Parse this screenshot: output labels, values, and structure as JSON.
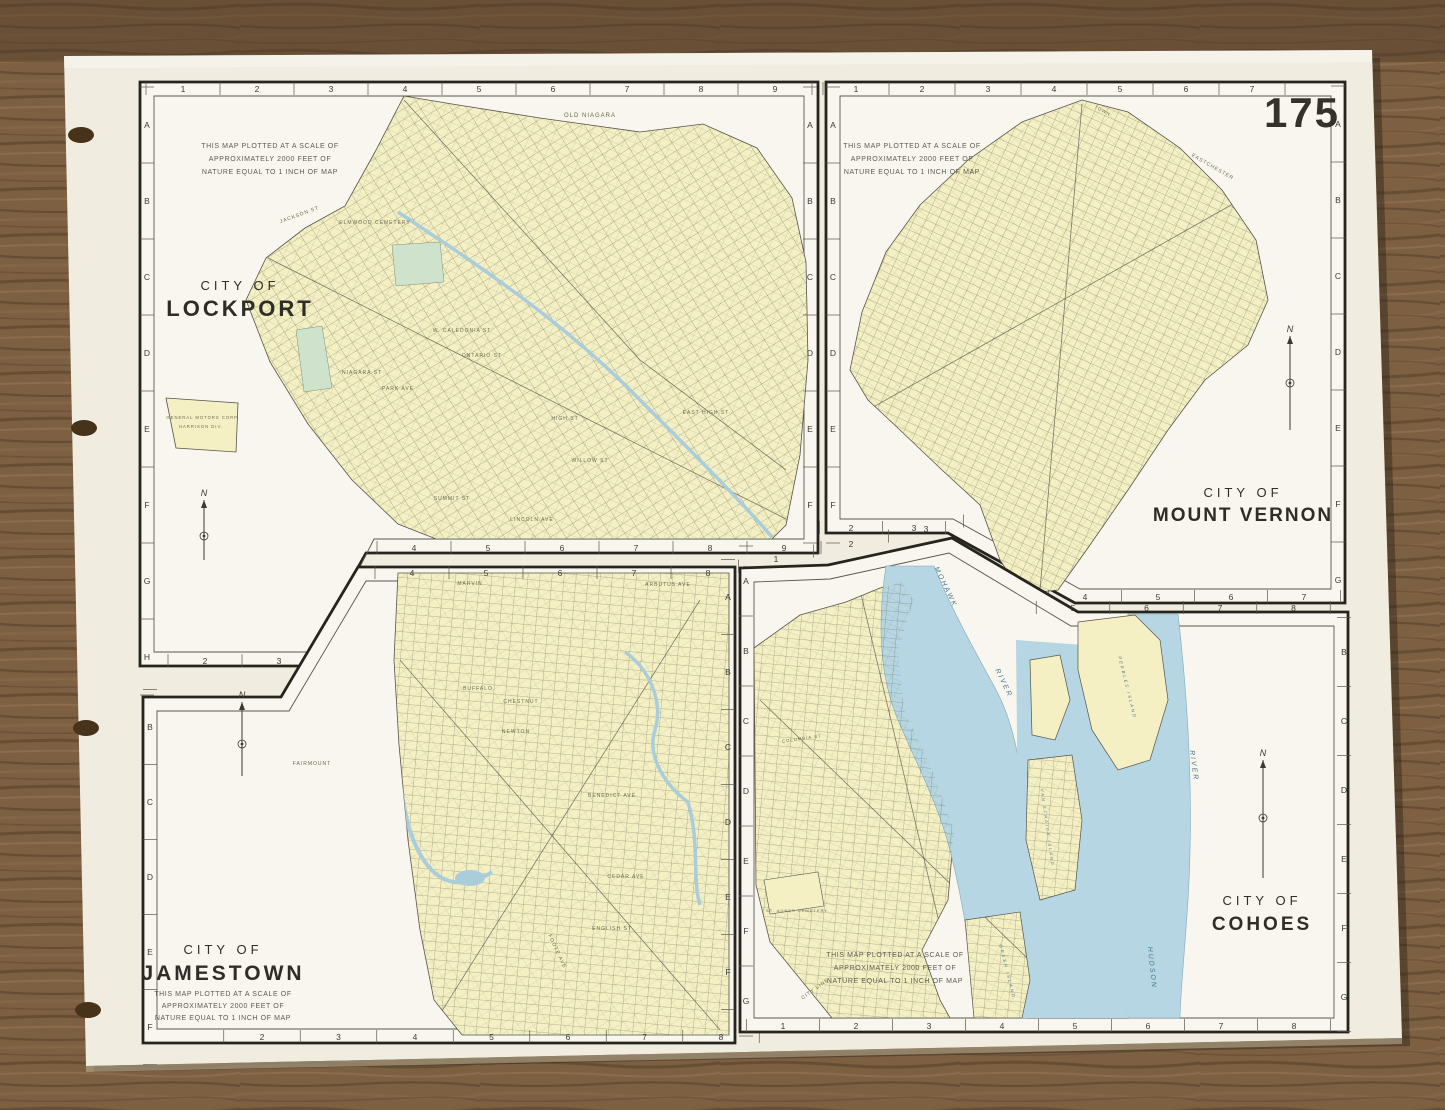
{
  "page_number": "175",
  "colors": {
    "wood": "#7d5f42",
    "wood_dark": "#4f3b27",
    "wood_light": "#98795a",
    "paper": "#f0ecdf",
    "panel_bg": "#f8f6ee",
    "map_fill": "#f4f0c4",
    "water": "#b5d6e2",
    "park": "#cfe2cb",
    "ink": "#26241f"
  },
  "panels": {
    "lockport": {
      "title_top": "CITY OF",
      "title_city": "LOCKPORT",
      "scale_note": [
        "THIS MAP PLOTTED AT A SCALE OF",
        "APPROXIMATELY  2000 FEET OF",
        "NATURE EQUAL TO 1 INCH OF MAP"
      ],
      "compass": "N",
      "rulers": {
        "top": [
          "1",
          "2",
          "3",
          "4",
          "5",
          "6",
          "7",
          "8",
          "9"
        ],
        "bottom": [
          "4",
          "5",
          "6",
          "7",
          "8",
          "9"
        ],
        "bottom_left": [
          "2",
          "3"
        ],
        "left": [
          "A",
          "B",
          "C",
          "D",
          "E",
          "F",
          "G",
          "H"
        ],
        "right": [
          "A",
          "B",
          "C",
          "D",
          "E",
          "F"
        ]
      },
      "features": [
        "OLD NIAGARA",
        "ELMWOOD CEMETERY",
        "GENERAL MOTORS CORP.",
        "HARRISON DIV.",
        "ONTARIO ST",
        "NIAGARA ST",
        "PARK AVE",
        "HIGH ST",
        "EAST HIGH ST",
        "WILLOW ST",
        "SUMMIT ST",
        "LINCOLN AVE",
        "W. CALEDONIA ST",
        "JACKSON ST"
      ]
    },
    "mount_vernon": {
      "title_top": "CITY OF",
      "title_city": "MOUNT VERNON",
      "scale_note": [
        "THIS MAP PLOTTED AT A SCALE OF",
        "APPROXIMATELY  2000 FEET OF",
        "NATURE EQUAL TO 1 INCH OF MAP"
      ],
      "compass": "N",
      "rulers": {
        "top": [
          "1",
          "2",
          "3",
          "4",
          "5",
          "6",
          "7"
        ],
        "bottom": [
          "4",
          "5",
          "6",
          "7"
        ],
        "bottom_left": [
          "2",
          "3"
        ],
        "left": [
          "A",
          "B",
          "C",
          "D",
          "E",
          "F"
        ],
        "right": [
          "A",
          "B",
          "C",
          "D",
          "E",
          "F",
          "G"
        ]
      },
      "features": [
        "TOWN",
        "EASTCHESTER"
      ]
    },
    "jamestown": {
      "title_top": "CITY OF",
      "title_city": "JAMESTOWN",
      "scale_note": [
        "THIS MAP PLOTTED AT A SCALE OF",
        "APPROXIMATELY  2000 FEET OF",
        "NATURE EQUAL TO 1 INCH OF MAP"
      ],
      "compass": "N",
      "rulers": {
        "top": [
          "4",
          "5",
          "6",
          "7",
          "8"
        ],
        "bottom": [
          "2",
          "3",
          "4",
          "5",
          "6",
          "7",
          "8"
        ],
        "left": [
          "B",
          "C",
          "D",
          "E",
          "F"
        ],
        "right": [
          "A",
          "B",
          "C",
          "D",
          "E",
          "F"
        ]
      },
      "features": [
        "MARVIN",
        "ARBUTUS AVE",
        "BUFFALO",
        "CHESTNUT",
        "NEWTON",
        "BENEDICT AVE",
        "CEDAR AVE",
        "FAIRMOUNT",
        "ENGLISH ST",
        "FOOTE AVE"
      ]
    },
    "cohoes": {
      "title_top": "CITY OF",
      "title_city": "COHOES",
      "scale_note": [
        "THIS MAP PLOTTED AT A SCALE OF",
        "APPROXIMATELY  2000 FEET OF",
        "NATURE EQUAL TO 1 INCH OF MAP"
      ],
      "compass": "N",
      "rulers": {
        "top_left": [
          "1",
          "2",
          "3"
        ],
        "top_right": [
          "5",
          "6",
          "7",
          "8"
        ],
        "bottom": [
          "1",
          "2",
          "3",
          "4",
          "5",
          "6",
          "7",
          "8"
        ],
        "left": [
          "A",
          "B",
          "C",
          "D",
          "E",
          "F",
          "G"
        ],
        "right": [
          "B",
          "C",
          "D",
          "E",
          "F",
          "G"
        ]
      },
      "water_labels": [
        "MOHAWK",
        "RIVER",
        "HUDSON",
        "RIVER",
        "PEEBLES ISLAND",
        "VAN SCHAICK ISLAND",
        "GREEN ISLAND"
      ],
      "land_labels": [
        "ST. AGNES CEMETERY",
        "CITY LINE",
        "COLUMBIA ST"
      ]
    }
  }
}
